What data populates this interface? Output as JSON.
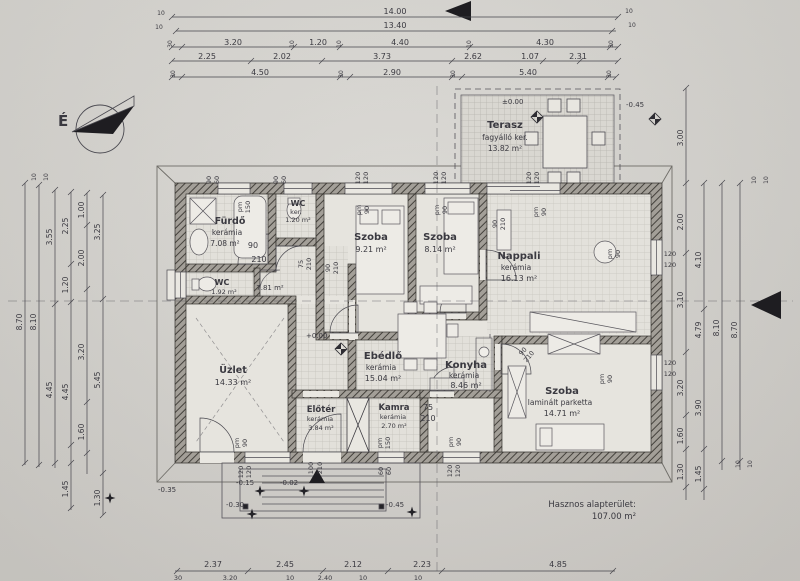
{
  "sheet": {
    "footer_label": "Hasznos alapterület:",
    "footer_value": "107.00 m²",
    "compass": "É"
  },
  "levels": {
    "terrace_zero": "±0.00",
    "terrace_minus": "-0.45",
    "floor_zero": "+0.00",
    "garden": "-0.35",
    "porch_a": "-0.15",
    "porch_b": "-0.02",
    "porch_c": "-0.30",
    "porch_d": "-0.45"
  },
  "rooms": {
    "terasz": {
      "name": "Terasz",
      "material": "fagyálló ker.",
      "area": "13.82 m²"
    },
    "furdo": {
      "name": "Fürdő",
      "material": "kerámia",
      "area": "7.08 m²"
    },
    "wcs": {
      "name": "WC",
      "material": "ker.",
      "area": "1.20 m²"
    },
    "szoba1": {
      "name": "Szoba",
      "area": "9.21 m²"
    },
    "szoba2": {
      "name": "Szoba",
      "area": "8.14 m²"
    },
    "nappali": {
      "name": "Nappali",
      "material": "kerámia",
      "area": "16.13 m²"
    },
    "wc": {
      "name": "WC",
      "area": "1.92 m²"
    },
    "kozlekedo": {
      "area": "7.81 m²"
    },
    "uzlet": {
      "name": "Üzlet",
      "area": "14.33 m²"
    },
    "ebedlo": {
      "name": "Ebédlő",
      "material": "kerámia",
      "area": "15.04 m²"
    },
    "konyha": {
      "name": "Konyha",
      "material": "kerámia",
      "area": "8.46 m²"
    },
    "szoba3": {
      "name": "Szoba",
      "material": "laminált parketta",
      "area": "14.71 m²"
    },
    "eloter": {
      "name": "Előtér",
      "material": "kerámia",
      "area": "3.84 m²"
    },
    "kamra": {
      "name": "Kamra",
      "material": "kerámia",
      "area": "2.70 m²"
    }
  },
  "openings": {
    "n10": "10",
    "n30": "30",
    "n60": "60",
    "n75": "75",
    "n90": "90",
    "n100": "100",
    "n120": "120",
    "n150": "150",
    "n210": "210",
    "pm": "pm"
  },
  "dims": {
    "top": {
      "total": "14.00",
      "inner": "13.40",
      "row3": [
        "30",
        "3.20",
        "10",
        "1.20",
        "10",
        "4.40",
        "10",
        "4.30",
        "30"
      ],
      "row4": [
        "2.25",
        "2.02",
        "3.73",
        "2.62",
        "1.07",
        "2.31"
      ],
      "row5": [
        "30",
        "4.50",
        "30",
        "2.90",
        "30",
        "5.40",
        "30"
      ],
      "corner": [
        "10",
        "10"
      ]
    },
    "bottom": {
      "row1": [
        "2.37",
        "2.45",
        "2.12",
        "2.23",
        "4.85"
      ],
      "row2": [
        "30",
        "3.20",
        "10",
        "2.40",
        "10",
        "10"
      ]
    },
    "left": {
      "c1": "8.70",
      "c2": "8.10",
      "c3": [
        "3.55",
        "4.45"
      ],
      "c4": [
        "2.25",
        "1.20",
        "4.45",
        "1.45"
      ],
      "c5": [
        "1.00",
        "2.00",
        "3.20",
        "1.60"
      ],
      "c6": [
        "3.25",
        "5.45",
        "1.30"
      ],
      "ticks": [
        "10",
        "10"
      ]
    },
    "right": {
      "terrace": "3.00",
      "c1": [
        "2.00",
        "3.10",
        "3.20",
        "1.60",
        "1.30"
      ],
      "c2": [
        "4.10",
        "4.79",
        "3.90",
        "1.45"
      ],
      "c3": "8.10",
      "c4": "8.70",
      "ticks": [
        "10",
        "10",
        "10",
        "10"
      ]
    }
  }
}
